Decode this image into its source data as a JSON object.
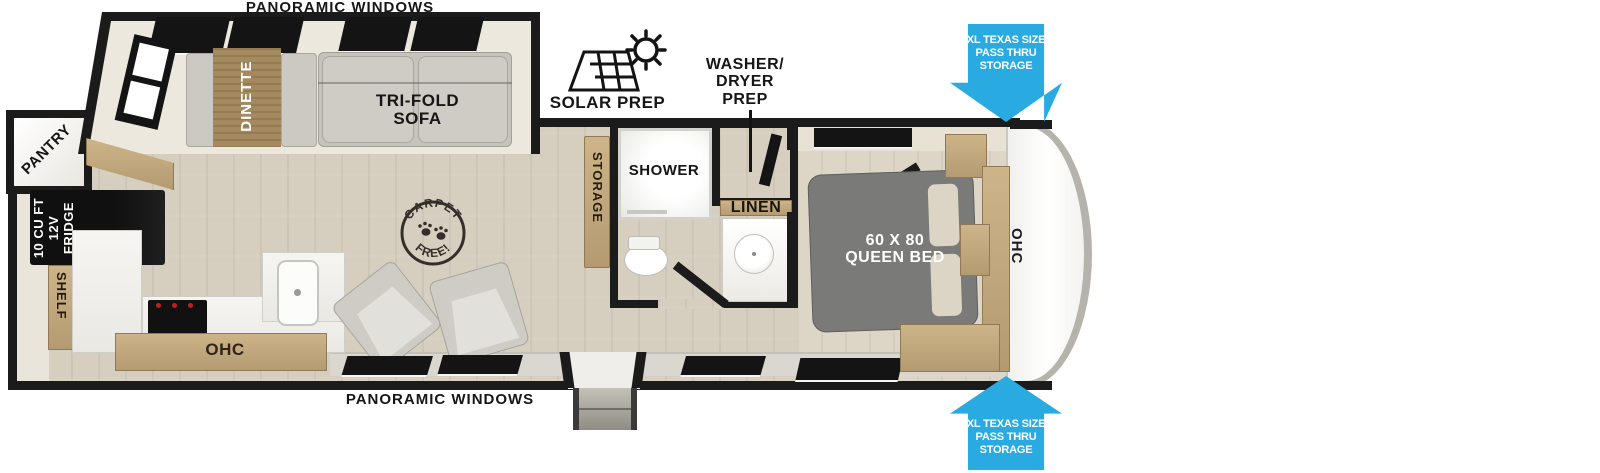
{
  "exterior": {
    "panoramic_windows_top": "PANORAMIC WINDOWS",
    "panoramic_windows_bottom": "PANORAMIC WINDOWS",
    "solar_prep": "SOLAR PREP",
    "washer_dryer_prep": "WASHER/\nDRYER\nPREP",
    "pass_thru_storage_top": "XL TEXAS SIZE\nPASS THRU\nSTORAGE",
    "pass_thru_storage_bottom": "XL TEXAS SIZE\nPASS THRU\nSTORAGE"
  },
  "living_area": {
    "pantry": "PANTRY",
    "dinette": "DINETTE",
    "trifold_sofa": "TRI-FOLD\nSOFA",
    "fridge": "10 CU FT\n12V\nFRIDGE",
    "shelf": "SHELF",
    "ohc": "OHC",
    "carpet_badge_top": "CARPET",
    "carpet_badge_bottom": "FREE!"
  },
  "bathroom": {
    "storage": "STORAGE",
    "shower": "SHOWER",
    "linen": "LINEN"
  },
  "bedroom": {
    "queen_bed": "60 X 80\nQUEEN BED",
    "ohc": "OHC"
  },
  "colors": {
    "callout_blue": "#29abe2",
    "wall": "#1b1b1b",
    "cabinet_tan": "#c0a67c",
    "bed_gray": "#7a7a78",
    "floor": "#d6cfc0"
  }
}
